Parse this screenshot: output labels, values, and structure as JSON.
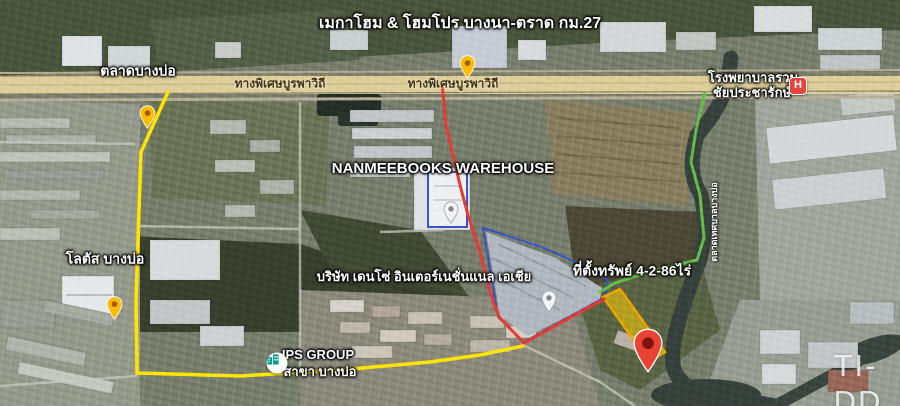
{
  "map": {
    "kind": "satellite-annotated",
    "labels": {
      "megahome": "เมกาโฮม & โฮมโปร บางนา-ตราด กม.27",
      "market": "ตลาดบางบ่อ",
      "expressway": "ทางพิเศษบูรพาวิถี",
      "hospital_line1": "โรงพยาบาลรวม",
      "hospital_line2": "ชัยประชารักษ์",
      "hospital_symbol": "H",
      "nanmee": "NANMEEBOOKS WAREHOUSE",
      "lotus": "โลตัส บางบ่อ",
      "denso": "บริษัท เดนโซ่ อินเตอร์เนชั่นแนล เอเชีย",
      "property": "ที่ตั้งทรัพย์ 4-2-86ไร่",
      "ips_line1": "IPS GROUP",
      "ips_line2": "สาขา บางบ่อ",
      "canal_road": "ตลาดเทศบาลบางบ่อ",
      "watermark": "TI-DD"
    },
    "property": {
      "area_rai": "4-2-86"
    },
    "markers": [
      {
        "name": "megahome-pin",
        "type": "yellow-pin"
      },
      {
        "name": "bangbo-market-pin",
        "type": "yellow-pin"
      },
      {
        "name": "lotus-pin",
        "type": "yellow-pin"
      },
      {
        "name": "hospital-marker",
        "type": "red-hospital-badge"
      },
      {
        "name": "nanmee-pin",
        "type": "grey-pin"
      },
      {
        "name": "denso-pin",
        "type": "grey-pin"
      },
      {
        "name": "property-pin",
        "type": "large-red-pin"
      },
      {
        "name": "ips-marker",
        "type": "white-circle-teal-icon"
      }
    ],
    "colors": {
      "route_yellow": "#ffe600",
      "route_red": "#e63c35",
      "route_green": "#6abf4b",
      "boundary_blue": "#3a57c9",
      "property_fill": "#ffd400",
      "property_border": "#f0a500",
      "pin_yellow": "#fbbc05",
      "pin_red": "#ea4335",
      "hospital_red": "#e5453d",
      "ips_teal": "#0f9d8f",
      "expressway_tan": "#decf9e"
    }
  }
}
